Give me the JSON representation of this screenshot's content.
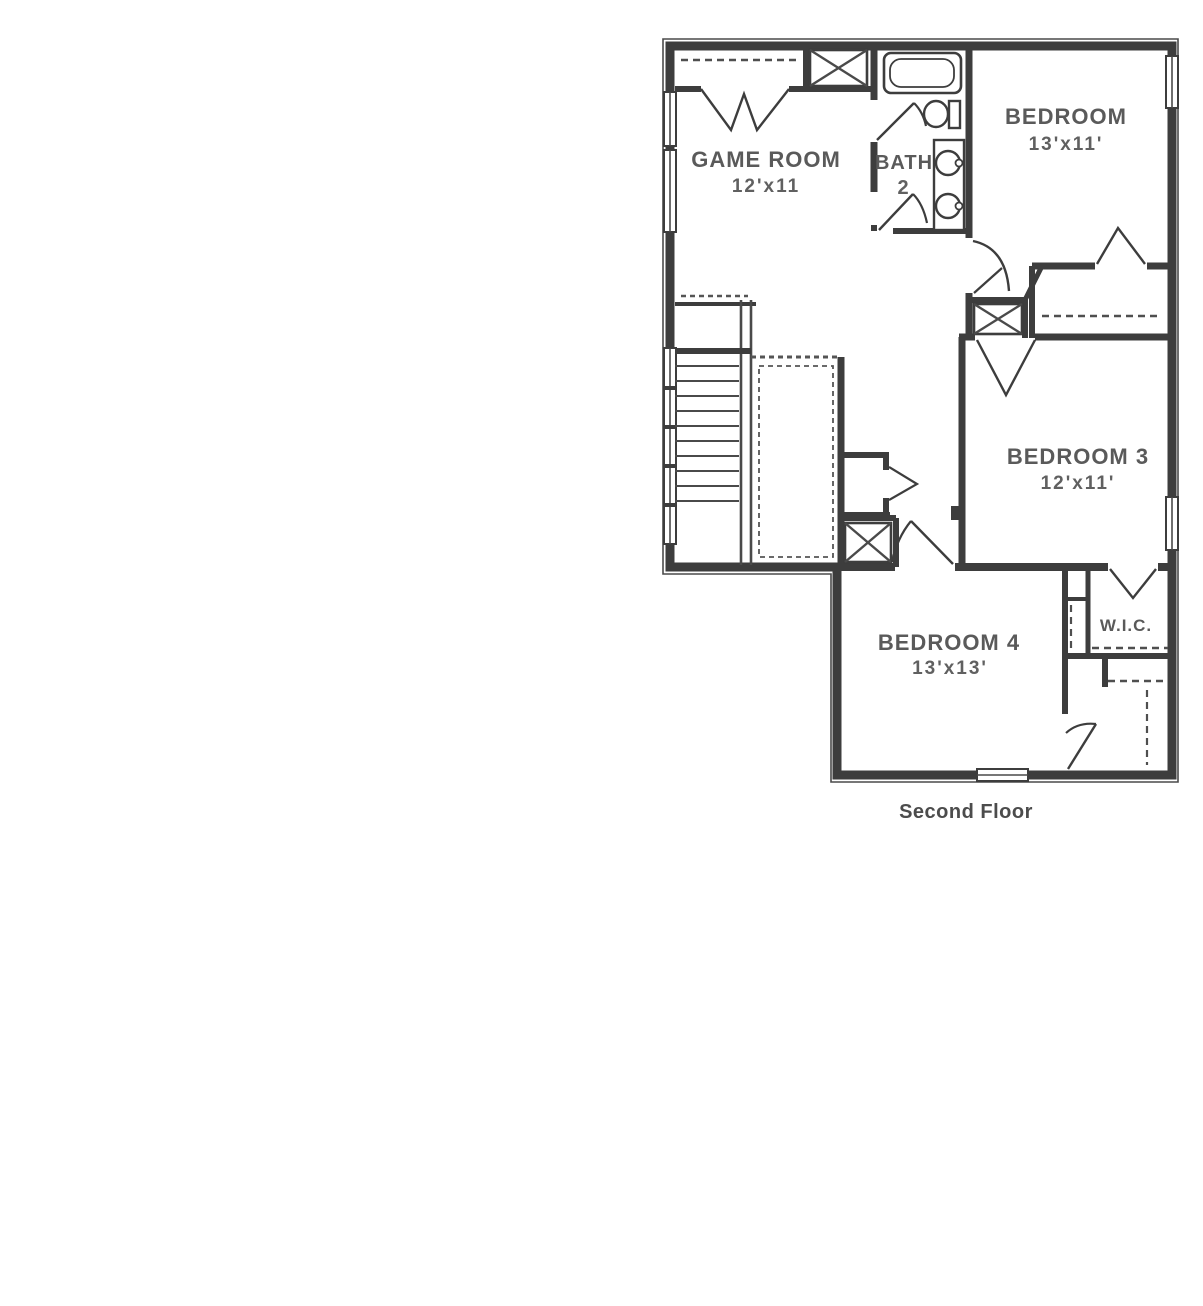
{
  "palette": {
    "background": "#ffffff",
    "wall_color": "#3d3d3d",
    "label_color": "#5a5a5a",
    "caption_color": "#4c4c4c"
  },
  "floorplan": {
    "caption": "Second Floor",
    "rooms": [
      {
        "id": "game-room",
        "label": "GAME ROOM",
        "dims": "12'x11"
      },
      {
        "id": "bath-2",
        "label": "BATH",
        "dims": "2"
      },
      {
        "id": "bedroom-2",
        "label": "BEDROOM",
        "dims": "13'x11'"
      },
      {
        "id": "bedroom-3",
        "label": "BEDROOM 3",
        "dims": "12'x11'"
      },
      {
        "id": "bedroom-4",
        "label": "BEDROOM 4",
        "dims": "13'x13'"
      },
      {
        "id": "wic",
        "label": "W.I.C."
      }
    ]
  }
}
